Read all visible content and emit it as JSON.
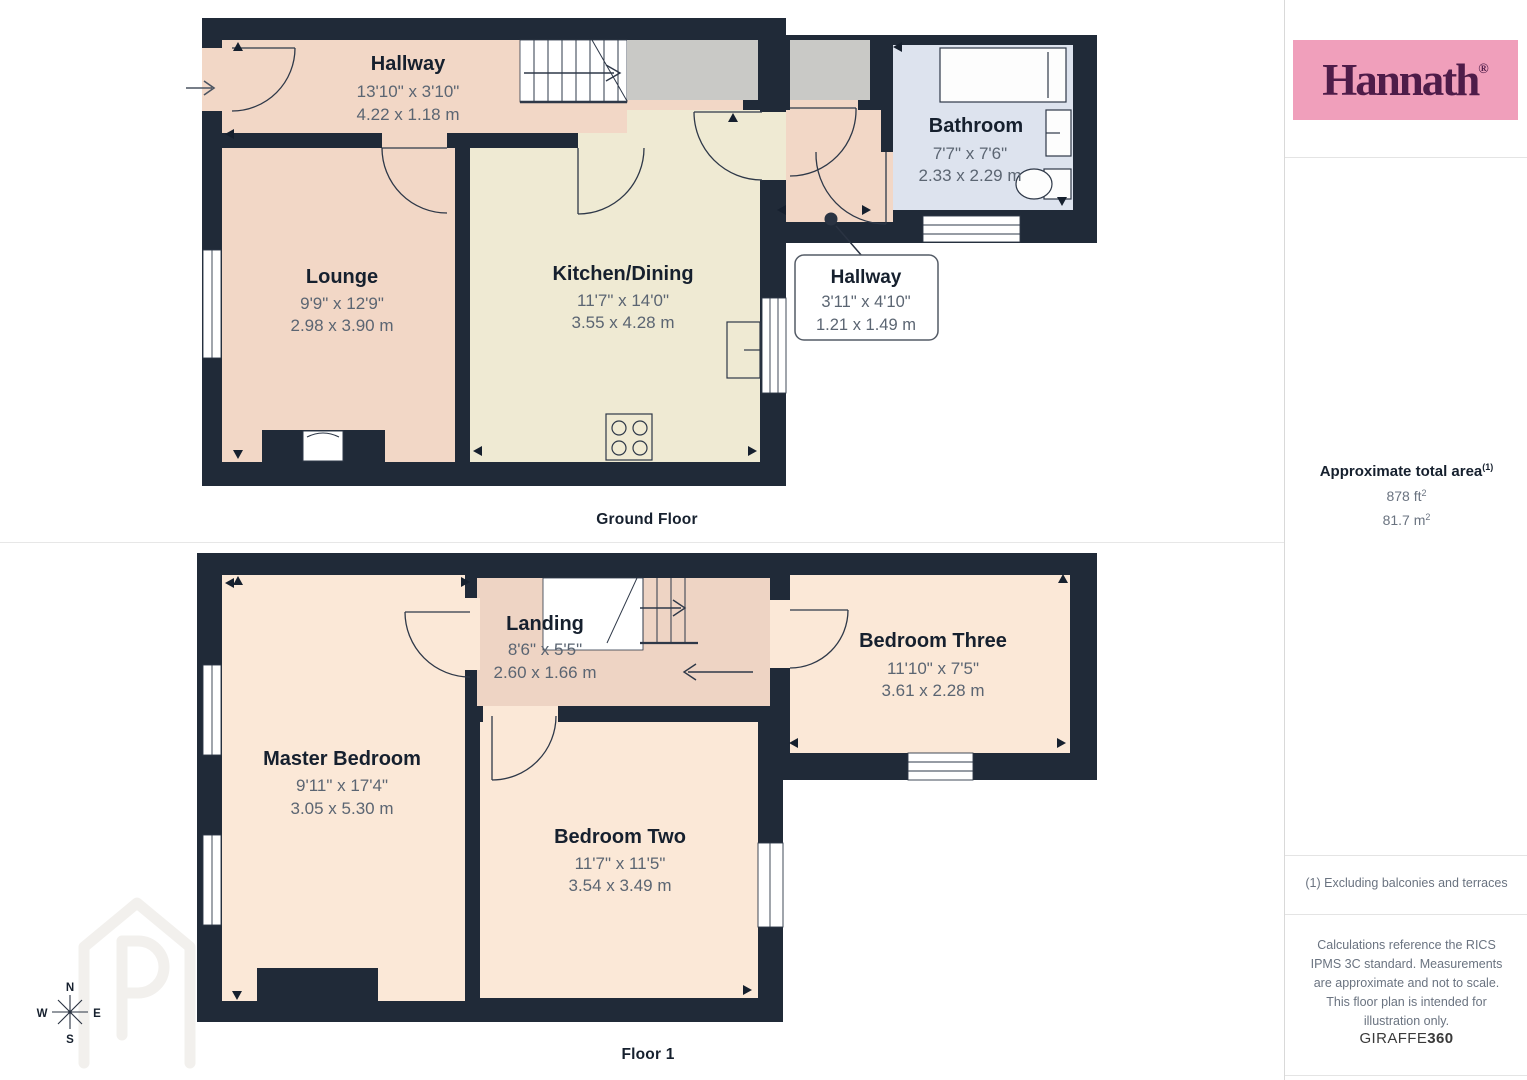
{
  "ground_floor": {
    "label": "Ground Floor",
    "hallway": {
      "name": "Hallway",
      "imp": "13'10\" x 3'10\"",
      "met": "4.22 x 1.18 m"
    },
    "lounge": {
      "name": "Lounge",
      "imp": "9'9\" x 12'9\"",
      "met": "2.98 x 3.90 m"
    },
    "kitchen_dining": {
      "name": "Kitchen/Dining",
      "imp": "11'7\" x 14'0\"",
      "met": "3.55 x 4.28 m"
    },
    "bathroom": {
      "name": "Bathroom",
      "imp": "7'7\" x 7'6\"",
      "met": "2.33 x 2.29 m"
    },
    "hallway_callout": {
      "name": "Hallway",
      "imp": "3'11\" x 4'10\"",
      "met": "1.21 x 1.49 m"
    }
  },
  "floor_one": {
    "label": "Floor 1",
    "master_bedroom": {
      "name": "Master Bedroom",
      "imp": "9'11\" x 17'4\"",
      "met": "3.05 x 5.30 m"
    },
    "landing": {
      "name": "Landing",
      "imp": "8'6\" x 5'5\"",
      "met": "2.60 x 1.66 m"
    },
    "bedroom_two": {
      "name": "Bedroom Two",
      "imp": "11'7\" x 11'5\"",
      "met": "3.54 x 3.49 m"
    },
    "bedroom_three": {
      "name": "Bedroom Three",
      "imp": "11'10\" x 7'5\"",
      "met": "3.61 x 2.28 m"
    }
  },
  "compass": {
    "north": "N",
    "south": "S",
    "east": "E",
    "west": "W"
  },
  "sidebar": {
    "brand": "Hannath",
    "brand_mark": "®",
    "area_title": "Approximate total area",
    "area_sup": "(1)",
    "area_ft_value": "878 ft",
    "area_m_value": "81.7 m",
    "sup_two": "2",
    "footnote": "(1) Excluding balconies and terraces",
    "disclaimer": "Calculations reference the RICS IPMS 3C standard. Measurements are approximate and not to scale. This floor plan is intended for illustration only.",
    "giraffe_brand": "GIRAFFE",
    "giraffe_360": "360"
  },
  "colors": {
    "wall": "#202a38",
    "room_peach": "#f2d7c6",
    "room_cream": "#efead3",
    "room_blue": "#dde3ee",
    "room_gray": "#c9c9c6",
    "room_bedroom": "#fbe8d7",
    "room_landing": "#eed4c4",
    "brand_pink": "#f09fbb",
    "brand_purple": "#4e1c49"
  }
}
